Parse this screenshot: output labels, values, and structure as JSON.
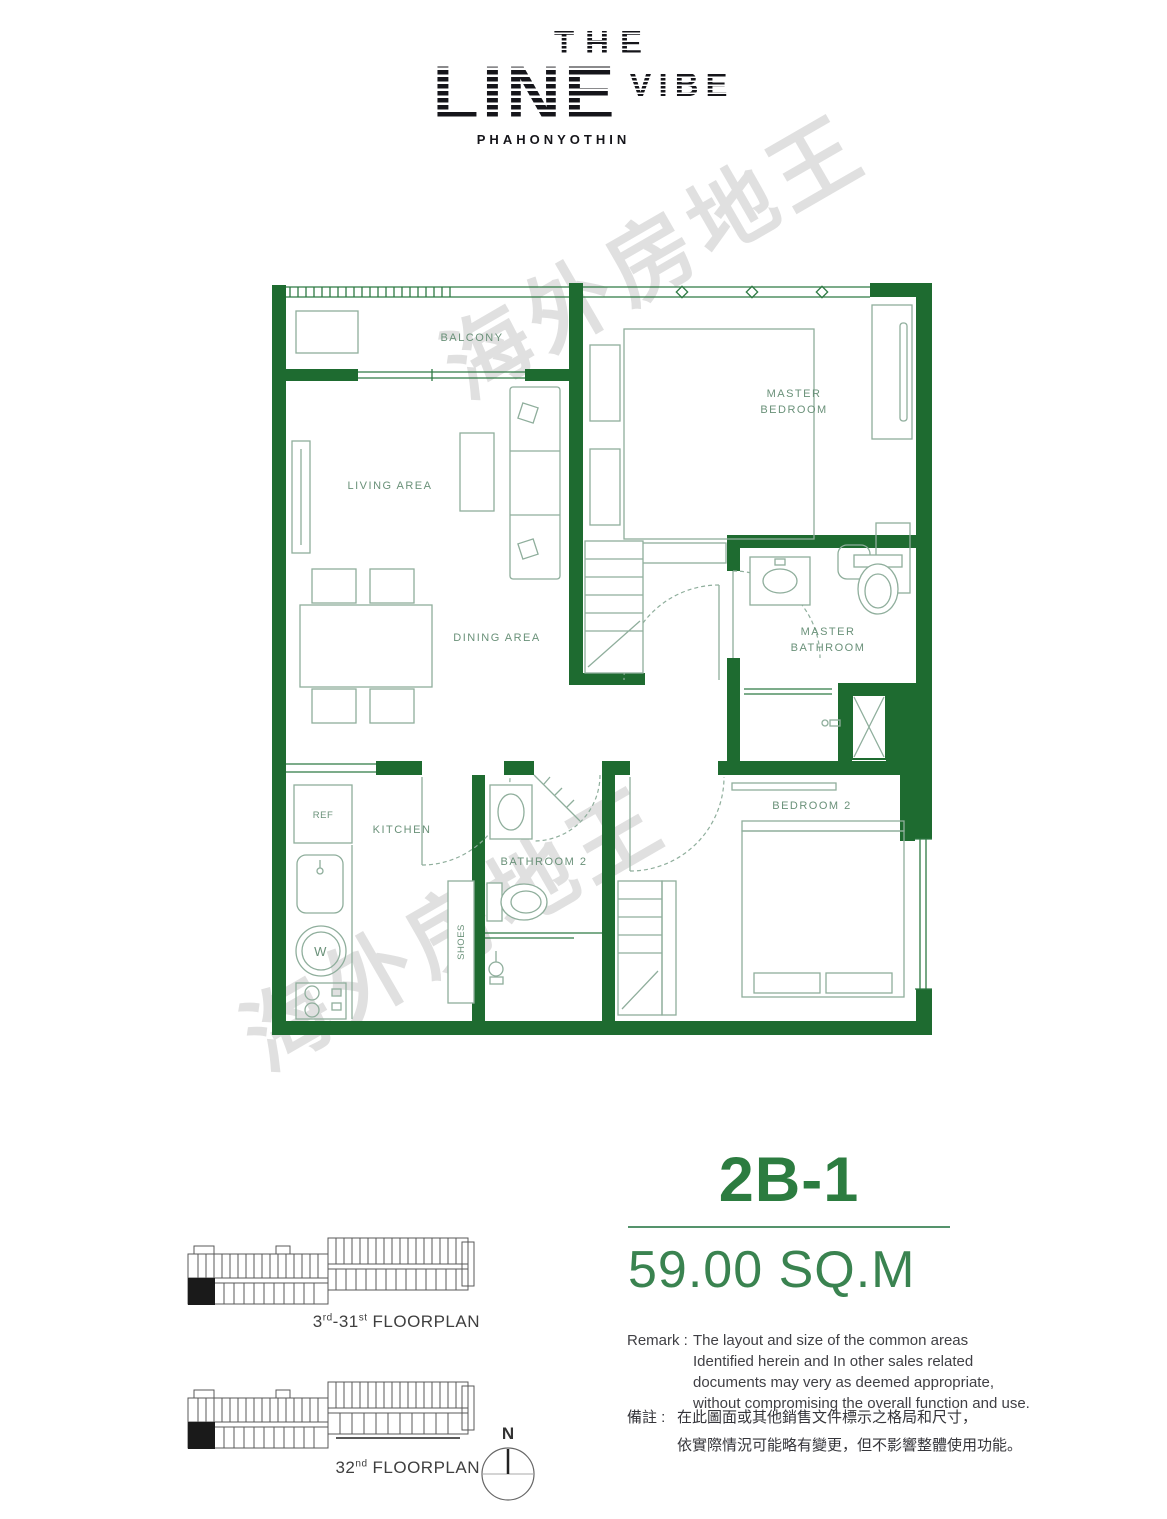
{
  "logo": {
    "the": "THE",
    "line": "LINE",
    "vibe": "VIBE",
    "subtitle": "PHAHONYOTHIN"
  },
  "watermark": "海外房地王",
  "floor_plan": {
    "labels": {
      "balcony": "BALCONY",
      "living": "LIVING AREA",
      "dining": "DINING AREA",
      "master_bedroom_line1": "MASTER",
      "master_bedroom_line2": "BEDROOM",
      "master_bathroom_line1": "MASTER",
      "master_bathroom_line2": "BATHROOM",
      "kitchen": "KITCHEN",
      "bathroom2": "BATHROOM 2",
      "bedroom2": "BEDROOM 2",
      "fridge": "REF",
      "shoes": "SHOES",
      "washer": "W"
    }
  },
  "unit": {
    "name": "2B-1",
    "area": "59.00 SQ.M"
  },
  "remark_en": {
    "label": "Remark :",
    "line1": "The layout and size of the common areas",
    "line2": "Identified herein and In other sales related",
    "line3": "documents may very as deemed appropriate,",
    "line4": "without compromising the overall function and use."
  },
  "remark_zh": {
    "label": "備註 :",
    "line1": "在此圖面或其他銷售文件標示之格局和尺寸，",
    "line2": "依實際情況可能略有變更，但不影響整體使用功能。"
  },
  "floorplans": {
    "first": {
      "base": "3",
      "sup_a": "rd",
      "mid": "-31",
      "sup_b": "st",
      "word": "FLOORPLAN"
    },
    "second": {
      "base": "32",
      "sup_a": "nd",
      "mid": "",
      "sup_b": "",
      "word": "FLOORPLAN"
    }
  },
  "compass": {
    "north": "N"
  },
  "colors": {
    "wall_green": "#1e6b30",
    "unit_green": "#2c7c40",
    "area_green": "#3a8350",
    "divider_green": "#55936c",
    "furniture_green": "#8fae9c",
    "label_green": "#6a9179",
    "text_dark": "#404045"
  }
}
